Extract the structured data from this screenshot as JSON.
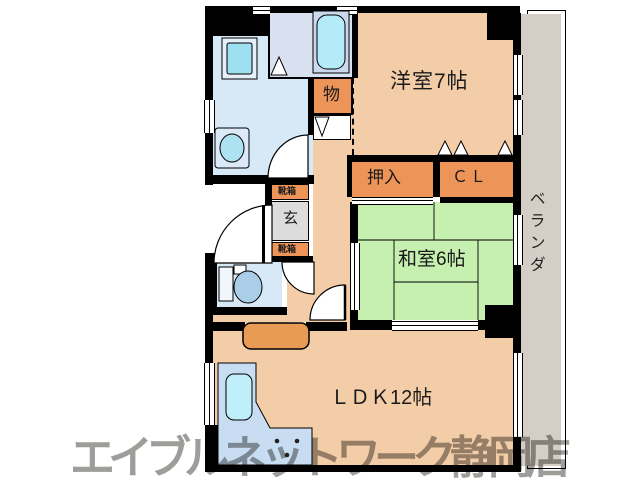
{
  "floor_plan": {
    "rooms": {
      "western_room": {
        "label": "洋室7帖",
        "color": "#F3CDA8"
      },
      "japanese_room": {
        "label": "和室6帖",
        "color": "#C6F0AF"
      },
      "ldk": {
        "label": "ＬＤＫ12帖",
        "color": "#F3CDA8"
      },
      "oshiire_closet": {
        "label": "押入",
        "color": "#ED9458"
      },
      "cl_closet": {
        "label": "ＣＬ",
        "color": "#ED9458"
      },
      "storage": {
        "label": "物",
        "color": "#ED9458"
      },
      "entrance": {
        "label": "玄",
        "color": "#DCDCDC"
      },
      "shoe_box": {
        "label": "靴箱",
        "color": "#ED9458"
      },
      "veranda": {
        "label": "ベランダ",
        "color": "#D5CEC7"
      }
    },
    "watermark": {
      "text": "エイブルネットワーク静岡店",
      "color": "#9C9890"
    }
  }
}
